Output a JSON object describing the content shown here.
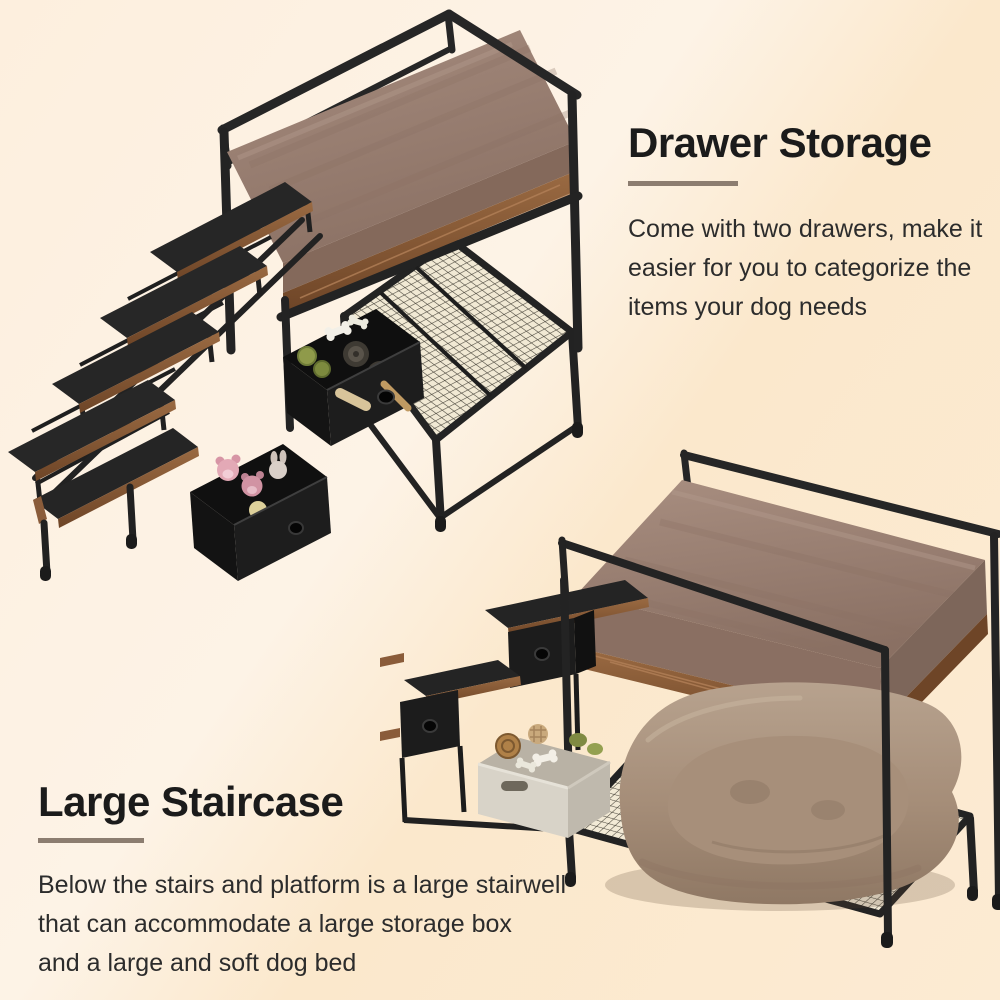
{
  "canvas": {
    "width": 1000,
    "height": 1000
  },
  "background": {
    "top_left": "#fdefde",
    "highlight_band": "#fdf3e6",
    "bottom_right": "#fbe8cc"
  },
  "sections": {
    "drawer_storage": {
      "heading": "Drawer Storage",
      "body_lines": [
        "Come with two drawers, make it",
        "easier for you to categorize the",
        "items your dog needs"
      ]
    },
    "large_staircase": {
      "heading": "Large Staircase",
      "body_lines": [
        "Below the stairs and platform is a large stairwell",
        "that can accommodate a large storage box",
        "and a large and soft dog bed"
      ]
    }
  },
  "styles": {
    "heading_color": "#1b1b1b",
    "body_color": "#2c2c2c",
    "divider_color": "#8c7d70"
  },
  "illustrations": {
    "isometric_view": {
      "label": "Isometric dog bed platform with 4-step staircase, two pulled-out fabric drawers holding dog toys and plush toys, and a metal mesh shelf"
    },
    "front_view": {
      "label": "Dog bed platform over a large stairwell holding a storage box and a large soft dog bed on a mesh base"
    }
  },
  "palette": {
    "metal_frame": "#242424",
    "cushion": "#9c8376",
    "wood_trim": "#8a5c3a",
    "mesh": "#f1e9d4",
    "drawer_fabric": "#1d1d1d",
    "dog_bed": "#ab937e",
    "storage_box": "#d8d3c8"
  }
}
